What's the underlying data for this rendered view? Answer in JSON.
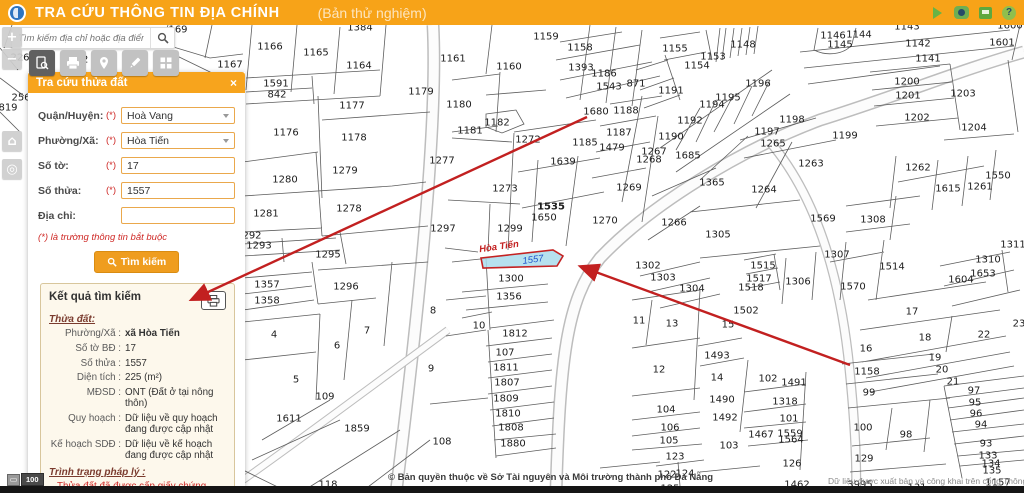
{
  "header": {
    "title": "TRA CỨU THÔNG TIN ĐỊA CHÍNH",
    "subtitle": "(Bản thử nghiệm)",
    "help_glyph": "?"
  },
  "search": {
    "placeholder": "Tìm kiếm địa chỉ hoặc địa điểm"
  },
  "map_controls": {
    "zoom_in": "+",
    "zoom_out": "−",
    "home": "⌂",
    "locate": "◎"
  },
  "panel": {
    "title": "Tra cứu thửa đất",
    "close_glyph": "×",
    "fields": [
      {
        "id": "district",
        "label": "Quận/Huyện:",
        "required": "(*)",
        "type": "select",
        "value": "Hoà Vang"
      },
      {
        "id": "ward",
        "label": "Phường/Xã:",
        "required": "(*)",
        "type": "select",
        "value": "Hòa Tiến"
      },
      {
        "id": "sheet",
        "label": "Số tờ:",
        "required": "(*)",
        "type": "text",
        "value": "17"
      },
      {
        "id": "parcel",
        "label": "Số thửa:",
        "required": "(*)",
        "type": "text",
        "value": "1557"
      },
      {
        "id": "address",
        "label": "Địa chỉ:",
        "required": "",
        "type": "text",
        "value": ""
      }
    ],
    "note": "(*) là trường thông tin bắt buộc",
    "search_button": "Tìm kiếm",
    "results": {
      "title": "Kết quả tìm kiếm",
      "section1": "Thửa đất:",
      "rows": [
        {
          "label": "Phường/Xã :",
          "value": "xã Hòa Tiến",
          "b": true
        },
        {
          "label": "Số tờ BĐ :",
          "value": "17"
        },
        {
          "label": "Số thửa :",
          "value": "1557"
        },
        {
          "label": "Diện tích :",
          "value": "225 (m²)"
        },
        {
          "label": "MĐSD :",
          "value": "ONT (Đất ở tại nông thôn)"
        },
        {
          "label": "Quy hoạch :",
          "value": "Dữ liệu về quy hoạch đang được cập nhật"
        },
        {
          "label": "Kế hoạch SDĐ :",
          "value": "Dữ liệu về kế hoạch đang được cập nhật"
        }
      ],
      "section2": "Trình trạng pháp lý :",
      "legal_status": "Thửa đất đã được cấp giấy chứng nhận"
    }
  },
  "map": {
    "highlight": {
      "name": "Hòa Tiến",
      "parcel": "1557"
    },
    "scale_value": "100",
    "attribution": "© Bản quyền thuộc về Sở Tài nguyên và Môi trường thành phố Đà Nẵng",
    "attribution2": "Dữ liệu được xuất bản và công khai trên cổng Thông",
    "parcels": [
      [
        "169",
        178,
        30
      ],
      [
        "1167",
        230,
        65
      ],
      [
        "226",
        20,
        58
      ],
      [
        "22",
        82,
        60
      ],
      [
        "256",
        21,
        98
      ],
      [
        "819",
        8,
        108
      ],
      [
        "1384",
        360,
        28
      ],
      [
        "1166",
        270,
        47
      ],
      [
        "1165",
        316,
        53
      ],
      [
        "1164",
        359,
        66
      ],
      [
        "1591",
        276,
        84
      ],
      [
        "842",
        277,
        95
      ],
      [
        "1177",
        352,
        106
      ],
      [
        "1176",
        286,
        133
      ],
      [
        "1178",
        354,
        138
      ],
      [
        "1179",
        421,
        92
      ],
      [
        "1161",
        453,
        59
      ],
      [
        "1180",
        459,
        105
      ],
      [
        "1182",
        497,
        123
      ],
      [
        "1181",
        470,
        131
      ],
      [
        "1160",
        509,
        67
      ],
      [
        "1159",
        546,
        37
      ],
      [
        "1158",
        580,
        48
      ],
      [
        "1393",
        581,
        68
      ],
      [
        "1186",
        604,
        74
      ],
      [
        "1543",
        609,
        87
      ],
      [
        "1680",
        596,
        112
      ],
      [
        "1188",
        626,
        111
      ],
      [
        "1187",
        619,
        133
      ],
      [
        "1185",
        585,
        143
      ],
      [
        "1479",
        612,
        148
      ],
      [
        "1272",
        528,
        140
      ],
      [
        "1639",
        563,
        162
      ],
      [
        "1277",
        442,
        161
      ],
      [
        "1273",
        505,
        189
      ],
      [
        "1535",
        551,
        207,
        1
      ],
      [
        "1650",
        544,
        218
      ],
      [
        "1279",
        345,
        171
      ],
      [
        "1280",
        285,
        180
      ],
      [
        "1278",
        349,
        209
      ],
      [
        "1281",
        266,
        214
      ],
      [
        "1297",
        443,
        229
      ],
      [
        "1299",
        510,
        229
      ],
      [
        "292",
        252,
        236
      ],
      [
        "1293",
        259,
        246
      ],
      [
        "1295",
        328,
        255
      ],
      [
        "1269",
        629,
        188
      ],
      [
        "1270",
        605,
        221
      ],
      [
        "1143",
        907,
        27
      ],
      [
        "1155",
        675,
        49
      ],
      [
        "1153",
        713,
        57
      ],
      [
        "1154",
        697,
        66
      ],
      [
        "1148",
        743,
        45
      ],
      [
        "1196",
        758,
        84
      ],
      [
        "1195",
        728,
        98
      ],
      [
        "1194",
        712,
        105
      ],
      [
        "1192",
        690,
        121
      ],
      [
        "1191",
        671,
        91
      ],
      [
        "1190",
        671,
        137
      ],
      [
        "871",
        636,
        84
      ],
      [
        "1267",
        654,
        152
      ],
      [
        "1268",
        649,
        160
      ],
      [
        "1685",
        688,
        156
      ],
      [
        "1146",
        833,
        36
      ],
      [
        "1145",
        840,
        45
      ],
      [
        "1144",
        859,
        35
      ],
      [
        "1142",
        918,
        44
      ],
      [
        "1141",
        928,
        59
      ],
      [
        "1600",
        1010,
        26
      ],
      [
        "1601",
        1002,
        43
      ],
      [
        "1200",
        907,
        82
      ],
      [
        "1201",
        908,
        96
      ],
      [
        "1203",
        963,
        94
      ],
      [
        "1202",
        917,
        118
      ],
      [
        "1204",
        974,
        128
      ],
      [
        "1198",
        792,
        120
      ],
      [
        "1197",
        767,
        132
      ],
      [
        "1265",
        773,
        144
      ],
      [
        "1199",
        845,
        136
      ],
      [
        "1263",
        811,
        164
      ],
      [
        "1264",
        764,
        190
      ],
      [
        "1365",
        712,
        183
      ],
      [
        "1266",
        674,
        223
      ],
      [
        "1305",
        718,
        235
      ],
      [
        "1262",
        918,
        168
      ],
      [
        "1615",
        948,
        189
      ],
      [
        "1261",
        980,
        187
      ],
      [
        "1550",
        998,
        176
      ],
      [
        "1569",
        823,
        219
      ],
      [
        "1308",
        873,
        220
      ],
      [
        "1307",
        837,
        255
      ],
      [
        "1311",
        1013,
        245
      ],
      [
        "1357",
        267,
        285
      ],
      [
        "1358",
        267,
        301
      ],
      [
        "1296",
        346,
        287
      ],
      [
        "4",
        274,
        335
      ],
      [
        "7",
        367,
        331
      ],
      [
        "6",
        337,
        346
      ],
      [
        "5",
        296,
        380
      ],
      [
        "109",
        325,
        397
      ],
      [
        "1611",
        289,
        419
      ],
      [
        "1859",
        357,
        429
      ],
      [
        "8",
        433,
        311
      ],
      [
        "9",
        431,
        369
      ],
      [
        "10",
        479,
        326
      ],
      [
        "1300",
        511,
        279
      ],
      [
        "1356",
        509,
        297
      ],
      [
        "1812",
        515,
        334
      ],
      [
        "107",
        505,
        353
      ],
      [
        "1811",
        506,
        368
      ],
      [
        "1807",
        507,
        383
      ],
      [
        "1809",
        506,
        399
      ],
      [
        "1810",
        508,
        414
      ],
      [
        "1808",
        511,
        428
      ],
      [
        "1880",
        513,
        444
      ],
      [
        "108",
        442,
        442
      ],
      [
        "118",
        328,
        485
      ],
      [
        "1302",
        648,
        266
      ],
      [
        "1303",
        663,
        278
      ],
      [
        "1304",
        692,
        289
      ],
      [
        "1515",
        763,
        266
      ],
      [
        "1517",
        759,
        279
      ],
      [
        "1518",
        751,
        288
      ],
      [
        "1306",
        798,
        282
      ],
      [
        "1502",
        746,
        311
      ],
      [
        "15",
        728,
        325
      ],
      [
        "11",
        639,
        321
      ],
      [
        "13",
        672,
        324
      ],
      [
        "1493",
        717,
        356
      ],
      [
        "12",
        659,
        370
      ],
      [
        "14",
        717,
        378
      ],
      [
        "102",
        768,
        379
      ],
      [
        "1491",
        794,
        383
      ],
      [
        "1490",
        722,
        400
      ],
      [
        "1318",
        785,
        402
      ],
      [
        "1492",
        725,
        418
      ],
      [
        "101",
        789,
        419
      ],
      [
        "104",
        666,
        410
      ],
      [
        "106",
        670,
        428
      ],
      [
        "105",
        669,
        441
      ],
      [
        "1467",
        761,
        435
      ],
      [
        "1559",
        790,
        434
      ],
      [
        "1564",
        791,
        440
      ],
      [
        "103",
        729,
        446
      ],
      [
        "123",
        675,
        457
      ],
      [
        "122",
        667,
        475
      ],
      [
        "124",
        685,
        474
      ],
      [
        "126",
        792,
        464
      ],
      [
        "125",
        670,
        489
      ],
      [
        "1514",
        892,
        267
      ],
      [
        "1570",
        853,
        287
      ],
      [
        "1604",
        961,
        280
      ],
      [
        "1653",
        983,
        274
      ],
      [
        "1310",
        988,
        260
      ],
      [
        "17",
        912,
        312
      ],
      [
        "18",
        925,
        338
      ],
      [
        "16",
        866,
        349
      ],
      [
        "19",
        935,
        358
      ],
      [
        "20",
        942,
        370
      ],
      [
        "21",
        953,
        382
      ],
      [
        "22",
        984,
        335
      ],
      [
        "23",
        1019,
        324
      ],
      [
        "1158",
        867,
        372
      ],
      [
        "99",
        869,
        393
      ],
      [
        "97",
        974,
        391
      ],
      [
        "95",
        975,
        403
      ],
      [
        "96",
        976,
        414
      ],
      [
        "94",
        981,
        425
      ],
      [
        "100",
        863,
        428
      ],
      [
        "98",
        906,
        435
      ],
      [
        "93",
        986,
        444
      ],
      [
        "133",
        988,
        456
      ],
      [
        "134",
        991,
        464
      ],
      [
        "135",
        992,
        471
      ],
      [
        "129",
        864,
        459
      ],
      [
        "1157",
        998,
        483
      ],
      [
        "131",
        917,
        488
      ],
      [
        "1462",
        797,
        485
      ],
      [
        "3995",
        860,
        485
      ]
    ]
  }
}
